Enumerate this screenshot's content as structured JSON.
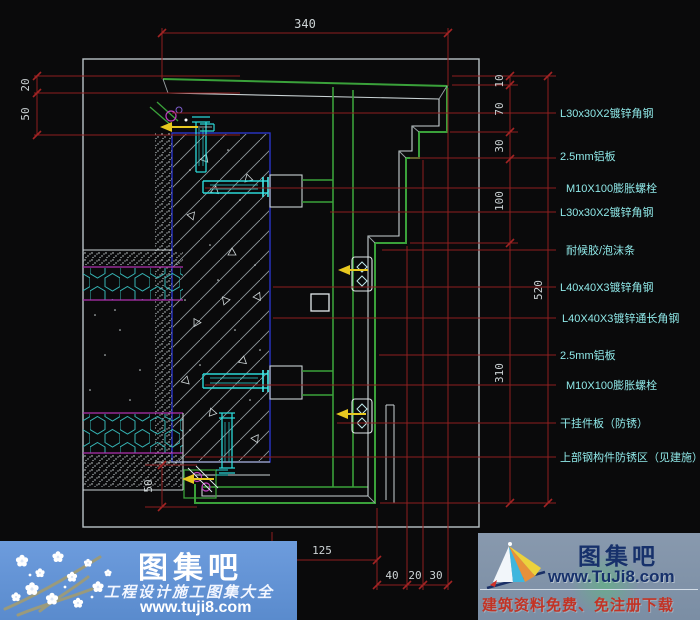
{
  "colors": {
    "background": "#0a0a0b",
    "frame_gray": "#b9c2c6",
    "dimension_red": "#8e1f1f",
    "dimension_text": "#ccd3d5",
    "callout_cyan": "#8fe8e8",
    "profile_green": "#3aa13a",
    "structure_white": "#c9d2d4",
    "bolt_cyan": "#2bd8d8",
    "wall_blue": "#2a35c8",
    "insulation_magenta": "#b030b0",
    "weld_yellow": "#e8c81f",
    "banner_left_blue": "#6d9cdd",
    "banner_right_gray": "#8899ae"
  },
  "drawing": {
    "dims": {
      "top": "340",
      "left_upper": "20",
      "left_lower": "50",
      "right_1": "10",
      "right_2": "70",
      "right_3": "30",
      "right_4": "100",
      "right_5": "310",
      "right_overall": "520",
      "bottom_left": "50",
      "bottom_1": "125",
      "bottom_2": "40",
      "bottom_3": "20",
      "bottom_4": "30"
    },
    "callouts": [
      "L30x30X2镀锌角钢",
      "2.5mm铝板",
      "M10X100膨胀螺栓",
      "L30x30X2镀锌角钢",
      "耐候胶/泡沫条",
      "L40x40X3镀锌角钢",
      "L40X40X3镀锌通长角钢",
      "2.5mm铝板",
      "M10X100膨胀螺栓",
      "干挂件板（防锈）",
      "上部钢构件防锈区（见建施）"
    ]
  },
  "watermark_left": {
    "site_name": "图集吧",
    "tagline": "工程设计施工图集大全",
    "url": "www.tuji8.com"
  },
  "watermark_right": {
    "site_name": "图集吧",
    "url": "www.TuJi8.com",
    "tagline": "建筑资料免费、免注册下载"
  }
}
